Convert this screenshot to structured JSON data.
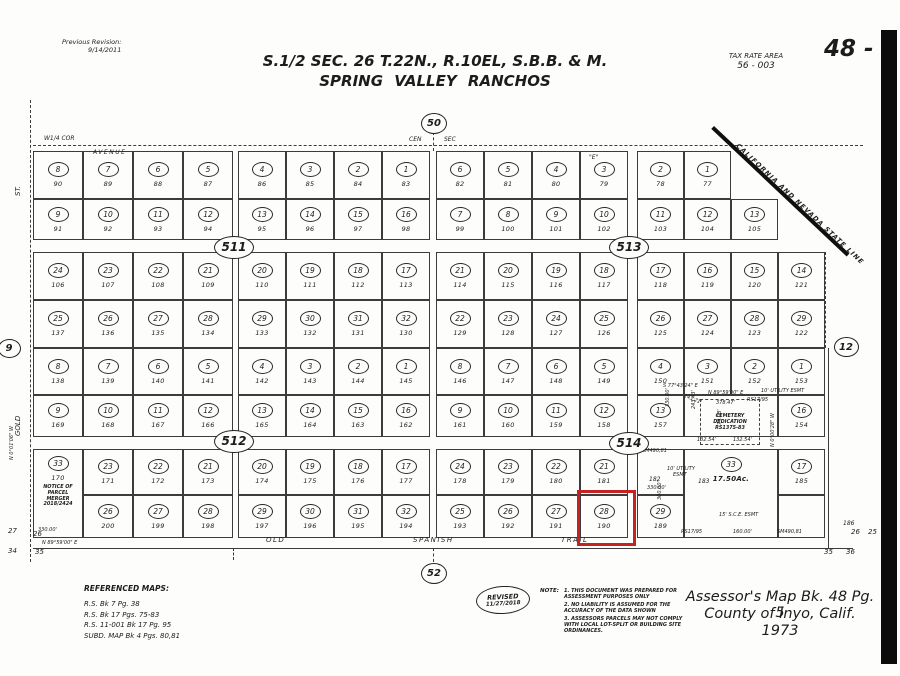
{
  "header": {
    "previous_revision_label": "Previous Revision:",
    "previous_revision_date": "9/14/2011",
    "title_line1": "S.1/2  SEC.  26  T.22N.,  R.10EL,  S.B.B.  &  M.",
    "title_line2": "SPRING  VALLEY  RANCHOS",
    "tax_rate_area_label": "TAX  RATE  AREA",
    "tax_rate_area_value": "56 - 003",
    "page_number": "48 - 5"
  },
  "footer": {
    "referenced_maps_title": "REFERENCED MAPS:",
    "referenced_maps": [
      "R.S.  Bk  7  Pg.  38",
      "R.S.  Bk  17  Pgs.  75-83",
      "R.S.  11-001  Bk  17  Pg.  95",
      "SUBD.  MAP  Bk  4  Pgs.  80,81"
    ],
    "revised_label": "REVISED",
    "revised_date": "11/27/2018",
    "note_label": "NOTE:",
    "notes": [
      "1. THIS DOCUMENT WAS PREPARED FOR ASSESSMENT PURPOSES ONLY",
      "2. NO LIABILITY IS ASSUMED FOR THE ACCURACY OF THE DATA SHOWN",
      "3. ASSESSORS PARCELS MAY NOT COMPLY WITH LOCAL LOT-SPLIT OR BUILDING SITE ORDINANCES."
    ],
    "assessor_line1": "Assessor's  Map  Bk.  48  Pg.  5",
    "assessor_line2": "County  of  Inyo,  Calif.",
    "assessor_line3": "1973"
  },
  "map": {
    "highlight_color": "#c62222",
    "state_line": {
      "x": 714,
      "y": 126,
      "len": 186,
      "deg": 43.3,
      "label": "CALIFORNIA AND NEVADA STATE LINE"
    },
    "red_box": {
      "x": 577,
      "y": 490,
      "w": 53,
      "h": 50
    },
    "black_bar": {
      "x": 881,
      "y": 30,
      "w": 16,
      "h": 634
    },
    "parcel_fields": [
      "x",
      "y",
      "w",
      "h",
      "circle",
      "number"
    ],
    "parcels": [
      [
        33,
        151,
        50,
        48,
        "8",
        "90"
      ],
      [
        83,
        151,
        50,
        48,
        "7",
        "89"
      ],
      [
        133,
        151,
        50,
        48,
        "6",
        "88"
      ],
      [
        183,
        151,
        50,
        48,
        "5",
        "87"
      ],
      [
        238,
        151,
        48,
        48,
        "4",
        "86"
      ],
      [
        286,
        151,
        48,
        48,
        "3",
        "85"
      ],
      [
        334,
        151,
        48,
        48,
        "2",
        "84"
      ],
      [
        382,
        151,
        48,
        48,
        "1",
        "83"
      ],
      [
        436,
        151,
        48,
        48,
        "6",
        "82"
      ],
      [
        484,
        151,
        48,
        48,
        "5",
        "81"
      ],
      [
        532,
        151,
        48,
        48,
        "4",
        "80"
      ],
      [
        580,
        151,
        48,
        48,
        "3",
        "79"
      ],
      [
        637,
        151,
        47,
        48,
        "2",
        "78"
      ],
      [
        684,
        151,
        47,
        48,
        "1",
        "77"
      ],
      [
        33,
        199,
        50,
        41,
        "9",
        "91"
      ],
      [
        83,
        199,
        50,
        41,
        "10",
        "92"
      ],
      [
        133,
        199,
        50,
        41,
        "11",
        "93"
      ],
      [
        183,
        199,
        50,
        41,
        "12",
        "94"
      ],
      [
        238,
        199,
        48,
        41,
        "13",
        "95"
      ],
      [
        286,
        199,
        48,
        41,
        "14",
        "96"
      ],
      [
        334,
        199,
        48,
        41,
        "15",
        "97"
      ],
      [
        382,
        199,
        48,
        41,
        "16",
        "98"
      ],
      [
        436,
        199,
        48,
        41,
        "7",
        "99"
      ],
      [
        484,
        199,
        48,
        41,
        "8",
        "100"
      ],
      [
        532,
        199,
        48,
        41,
        "9",
        "101"
      ],
      [
        580,
        199,
        48,
        41,
        "10",
        "102"
      ],
      [
        637,
        199,
        47,
        41,
        "11",
        "103"
      ],
      [
        684,
        199,
        47,
        41,
        "12",
        "104"
      ],
      [
        731,
        199,
        47,
        41,
        "13",
        "105"
      ],
      [
        33,
        252,
        50,
        48,
        "24",
        "106"
      ],
      [
        83,
        252,
        50,
        48,
        "23",
        "107"
      ],
      [
        133,
        252,
        50,
        48,
        "22",
        "108"
      ],
      [
        183,
        252,
        50,
        48,
        "21",
        "109"
      ],
      [
        238,
        252,
        48,
        48,
        "20",
        "110"
      ],
      [
        286,
        252,
        48,
        48,
        "19",
        "111"
      ],
      [
        334,
        252,
        48,
        48,
        "18",
        "112"
      ],
      [
        382,
        252,
        48,
        48,
        "17",
        "113"
      ],
      [
        436,
        252,
        48,
        48,
        "21",
        "114"
      ],
      [
        484,
        252,
        48,
        48,
        "20",
        "115"
      ],
      [
        532,
        252,
        48,
        48,
        "19",
        "116"
      ],
      [
        580,
        252,
        48,
        48,
        "18",
        "117"
      ],
      [
        637,
        252,
        47,
        48,
        "17",
        "118"
      ],
      [
        684,
        252,
        47,
        48,
        "16",
        "119"
      ],
      [
        731,
        252,
        47,
        48,
        "15",
        "120"
      ],
      [
        778,
        252,
        47,
        48,
        "14",
        "121"
      ],
      [
        33,
        300,
        50,
        48,
        "25",
        "137"
      ],
      [
        83,
        300,
        50,
        48,
        "26",
        "136"
      ],
      [
        133,
        300,
        50,
        48,
        "27",
        "135"
      ],
      [
        183,
        300,
        50,
        48,
        "28",
        "134"
      ],
      [
        238,
        300,
        48,
        48,
        "29",
        "133"
      ],
      [
        286,
        300,
        48,
        48,
        "30",
        "132"
      ],
      [
        334,
        300,
        48,
        48,
        "31",
        "131"
      ],
      [
        382,
        300,
        48,
        48,
        "32",
        "130"
      ],
      [
        436,
        300,
        48,
        48,
        "22",
        "129"
      ],
      [
        484,
        300,
        48,
        48,
        "23",
        "128"
      ],
      [
        532,
        300,
        48,
        48,
        "24",
        "127"
      ],
      [
        580,
        300,
        48,
        48,
        "25",
        "126"
      ],
      [
        637,
        300,
        47,
        48,
        "26",
        "125"
      ],
      [
        684,
        300,
        47,
        48,
        "27",
        "124"
      ],
      [
        731,
        300,
        47,
        48,
        "28",
        "123"
      ],
      [
        778,
        300,
        47,
        48,
        "29",
        "122"
      ],
      [
        33,
        348,
        50,
        47,
        "8",
        "138"
      ],
      [
        83,
        348,
        50,
        47,
        "7",
        "139"
      ],
      [
        133,
        348,
        50,
        47,
        "6",
        "140"
      ],
      [
        183,
        348,
        50,
        47,
        "5",
        "141"
      ],
      [
        238,
        348,
        48,
        47,
        "4",
        "142"
      ],
      [
        286,
        348,
        48,
        47,
        "3",
        "143"
      ],
      [
        334,
        348,
        48,
        47,
        "2",
        "144"
      ],
      [
        382,
        348,
        48,
        47,
        "1",
        "145"
      ],
      [
        436,
        348,
        48,
        47,
        "8",
        "146"
      ],
      [
        484,
        348,
        48,
        47,
        "7",
        "147"
      ],
      [
        532,
        348,
        48,
        47,
        "6",
        "148"
      ],
      [
        580,
        348,
        48,
        47,
        "5",
        "149"
      ],
      [
        637,
        348,
        47,
        47,
        "4",
        "150"
      ],
      [
        684,
        348,
        47,
        47,
        "3",
        "151"
      ],
      [
        731,
        348,
        47,
        47,
        "2",
        "152"
      ],
      [
        778,
        348,
        47,
        47,
        "1",
        "153"
      ],
      [
        33,
        395,
        50,
        42,
        "9",
        "169"
      ],
      [
        83,
        395,
        50,
        42,
        "10",
        "168"
      ],
      [
        133,
        395,
        50,
        42,
        "11",
        "167"
      ],
      [
        183,
        395,
        50,
        42,
        "12",
        "166"
      ],
      [
        238,
        395,
        48,
        42,
        "13",
        "165"
      ],
      [
        286,
        395,
        48,
        42,
        "14",
        "164"
      ],
      [
        334,
        395,
        48,
        42,
        "15",
        "163"
      ],
      [
        382,
        395,
        48,
        42,
        "16",
        "162"
      ],
      [
        436,
        395,
        48,
        42,
        "9",
        "161"
      ],
      [
        484,
        395,
        48,
        42,
        "10",
        "160"
      ],
      [
        532,
        395,
        48,
        42,
        "11",
        "159"
      ],
      [
        580,
        395,
        48,
        42,
        "12",
        "158"
      ],
      [
        637,
        395,
        47,
        42,
        "13",
        "157"
      ],
      [
        778,
        395,
        47,
        42,
        "16",
        "154"
      ],
      [
        83,
        449,
        50,
        46,
        "23",
        "171"
      ],
      [
        133,
        449,
        50,
        46,
        "22",
        "172"
      ],
      [
        183,
        449,
        50,
        46,
        "21",
        "173"
      ],
      [
        238,
        449,
        48,
        46,
        "20",
        "174"
      ],
      [
        286,
        449,
        48,
        46,
        "19",
        "175"
      ],
      [
        334,
        449,
        48,
        46,
        "18",
        "176"
      ],
      [
        382,
        449,
        48,
        46,
        "17",
        "177"
      ],
      [
        436,
        449,
        48,
        46,
        "24",
        "178"
      ],
      [
        484,
        449,
        48,
        46,
        "23",
        "179"
      ],
      [
        532,
        449,
        48,
        46,
        "22",
        "180"
      ],
      [
        580,
        449,
        48,
        46,
        "21",
        "181"
      ],
      [
        778,
        449,
        47,
        46,
        "17",
        "185"
      ],
      [
        83,
        495,
        50,
        43,
        "26",
        "200"
      ],
      [
        133,
        495,
        50,
        43,
        "27",
        "199"
      ],
      [
        183,
        495,
        50,
        43,
        "28",
        "198"
      ],
      [
        238,
        495,
        48,
        43,
        "29",
        "197"
      ],
      [
        286,
        495,
        48,
        43,
        "30",
        "196"
      ],
      [
        334,
        495,
        48,
        43,
        "31",
        "195"
      ],
      [
        382,
        495,
        48,
        43,
        "32",
        "194"
      ],
      [
        436,
        495,
        48,
        43,
        "25",
        "193"
      ],
      [
        484,
        495,
        48,
        43,
        "26",
        "192"
      ],
      [
        532,
        495,
        48,
        43,
        "27",
        "191"
      ],
      [
        580,
        495,
        48,
        43,
        "28",
        "190"
      ],
      [
        637,
        495,
        47,
        43,
        "29",
        "189"
      ],
      [
        684,
        395,
        94,
        42,
        "",
        ""
      ],
      [
        637,
        449,
        47,
        46,
        "",
        ""
      ],
      [
        778,
        495,
        47,
        43,
        "",
        ""
      ]
    ],
    "merged_parcel": {
      "x": 33,
      "y": 449,
      "w": 50,
      "h": 89,
      "circle": "33",
      "number": "170",
      "notice_lines": [
        "NOTICE OF",
        "PARCEL",
        "MERGER",
        "2018/2424"
      ]
    },
    "big_parcel": {
      "x": 684,
      "y": 449,
      "w": 94,
      "h": 89,
      "circle": "33",
      "acreage": "17.50Ac."
    },
    "cemetery_box": {
      "x": 700,
      "y": 399,
      "w": 58,
      "h": 44,
      "lines": [
        "CEMETERY",
        "DEDICATION",
        "RS1375-83"
      ]
    },
    "section_markers": [
      {
        "label": "50",
        "x": 433,
        "y": 122,
        "w": 24,
        "h": 19,
        "fs": 10
      },
      {
        "label": "52",
        "x": 433,
        "y": 572,
        "w": 24,
        "h": 19,
        "fs": 10
      },
      {
        "label": "9",
        "x": 8,
        "y": 347,
        "w": 21,
        "h": 17,
        "fs": 10
      },
      {
        "label": "12",
        "x": 845,
        "y": 346,
        "w": 23,
        "h": 18,
        "fs": 10
      },
      {
        "label": "511",
        "x": 233,
        "y": 246,
        "w": 38,
        "h": 21,
        "fs": 12
      },
      {
        "label": "513",
        "x": 628,
        "y": 246,
        "w": 38,
        "h": 21,
        "fs": 12
      },
      {
        "label": "512",
        "x": 233,
        "y": 440,
        "w": 38,
        "h": 21,
        "fs": 12
      },
      {
        "label": "514",
        "x": 628,
        "y": 442,
        "w": 38,
        "h": 21,
        "fs": 12
      }
    ],
    "lines": [
      {
        "x": 30,
        "y": 100,
        "w": 1,
        "h": 462,
        "d": 1
      },
      {
        "x": 33,
        "y": 145,
        "w": 830,
        "h": 1,
        "d": 1
      },
      {
        "x": 33,
        "y": 548,
        "w": 820,
        "h": 1
      },
      {
        "x": 433,
        "y": 132,
        "w": 1,
        "h": 19,
        "d": 1
      },
      {
        "x": 433,
        "y": 548,
        "w": 1,
        "h": 14,
        "d": 1
      },
      {
        "x": 233,
        "y": 548,
        "w": 1,
        "h": 12,
        "d": 1
      },
      {
        "x": 825,
        "y": 252,
        "w": 1,
        "h": 96,
        "d": 1
      },
      {
        "x": 828,
        "y": 348,
        "w": 1,
        "h": 200
      }
    ],
    "annotations": [
      {
        "t": "W1/4 COR",
        "x": 44,
        "y": 135,
        "fs": 6
      },
      {
        "t": "AVENUE",
        "x": 93,
        "y": 149,
        "fs": 6,
        "ls": 1.5
      },
      {
        "t": "CEN",
        "x": 409,
        "y": 136,
        "fs": 6
      },
      {
        "t": "SEC",
        "x": 444,
        "y": 136,
        "fs": 6
      },
      {
        "t": "\"E\"",
        "x": 589,
        "y": 154,
        "fs": 6
      },
      {
        "t": "ST.",
        "x": 14,
        "y": 196,
        "fs": 7,
        "rot": -90
      },
      {
        "t": "GOLD",
        "x": 14,
        "y": 436,
        "fs": 7,
        "rot": -90
      },
      {
        "t": "N 0°01'06\" W",
        "x": 9,
        "y": 460,
        "fs": 5,
        "rot": -90
      },
      {
        "t": "OLD",
        "x": 266,
        "y": 536,
        "fs": 7,
        "ls": 1.5
      },
      {
        "t": "SPANISH",
        "x": 413,
        "y": 536,
        "fs": 7,
        "ls": 1.5
      },
      {
        "t": "TRAIL",
        "x": 561,
        "y": 536,
        "fs": 7,
        "ls": 1.5
      },
      {
        "t": "330.00'",
        "x": 38,
        "y": 527,
        "fs": 5
      },
      {
        "t": "N 89°59'00\" E",
        "x": 42,
        "y": 540,
        "fs": 5
      },
      {
        "t": "27",
        "x": 8,
        "y": 527,
        "fs": 7
      },
      {
        "t": "26",
        "x": 33,
        "y": 530,
        "fs": 7
      },
      {
        "t": "34",
        "x": 8,
        "y": 547,
        "fs": 7
      },
      {
        "t": "35",
        "x": 35,
        "y": 548,
        "fs": 7
      },
      {
        "t": "186",
        "x": 843,
        "y": 520,
        "fs": 6
      },
      {
        "t": "26",
        "x": 851,
        "y": 528,
        "fs": 7
      },
      {
        "t": "25",
        "x": 868,
        "y": 528,
        "fs": 7
      },
      {
        "t": "35",
        "x": 824,
        "y": 548,
        "fs": 7
      },
      {
        "t": "36",
        "x": 846,
        "y": 548,
        "fs": 7
      },
      {
        "t": "S 77°43'24\" E",
        "x": 663,
        "y": 383,
        "fs": 5
      },
      {
        "t": "143.21'",
        "x": 685,
        "y": 393,
        "fs": 5,
        "rot": 22
      },
      {
        "t": "N 89°59'00\" E",
        "x": 708,
        "y": 390,
        "fs": 5
      },
      {
        "t": "10' UTILITY ESMT",
        "x": 761,
        "y": 388,
        "fs": 5
      },
      {
        "t": "RS17/95",
        "x": 747,
        "y": 397,
        "fs": 5
      },
      {
        "t": "378.47'",
        "x": 716,
        "y": 400,
        "fs": 5
      },
      {
        "t": "330.00'",
        "x": 665,
        "y": 407,
        "fs": 5,
        "rot": -90
      },
      {
        "t": "243.43'",
        "x": 691,
        "y": 409,
        "fs": 5,
        "rot": -90
      },
      {
        "t": "74.08'",
        "x": 717,
        "y": 425,
        "fs": 5,
        "rot": -90
      },
      {
        "t": "132.54'",
        "x": 697,
        "y": 437,
        "fs": 5
      },
      {
        "t": "132.54'",
        "x": 733,
        "y": 437,
        "fs": 5
      },
      {
        "t": "SM490,81",
        "x": 642,
        "y": 448,
        "fs": 5
      },
      {
        "t": "10' UTILITY",
        "x": 667,
        "y": 466,
        "fs": 5
      },
      {
        "t": "ESMT",
        "x": 673,
        "y": 472,
        "fs": 5
      },
      {
        "t": "183",
        "x": 698,
        "y": 478,
        "fs": 6
      },
      {
        "t": "182",
        "x": 649,
        "y": 476,
        "fs": 6
      },
      {
        "t": "330.00'",
        "x": 647,
        "y": 485,
        "fs": 5
      },
      {
        "t": "N 0°00'28\" W",
        "x": 770,
        "y": 447,
        "fs": 5,
        "rot": -90
      },
      {
        "t": "300.00'",
        "x": 657,
        "y": 500,
        "fs": 5,
        "rot": -90
      },
      {
        "t": "15' S.C.E. ESMT",
        "x": 719,
        "y": 512,
        "fs": 5
      },
      {
        "t": "RS17/95",
        "x": 681,
        "y": 529,
        "fs": 5
      },
      {
        "t": "160.00'",
        "x": 733,
        "y": 529,
        "fs": 5
      },
      {
        "t": "SM490,81",
        "x": 777,
        "y": 529,
        "fs": 5
      }
    ]
  }
}
